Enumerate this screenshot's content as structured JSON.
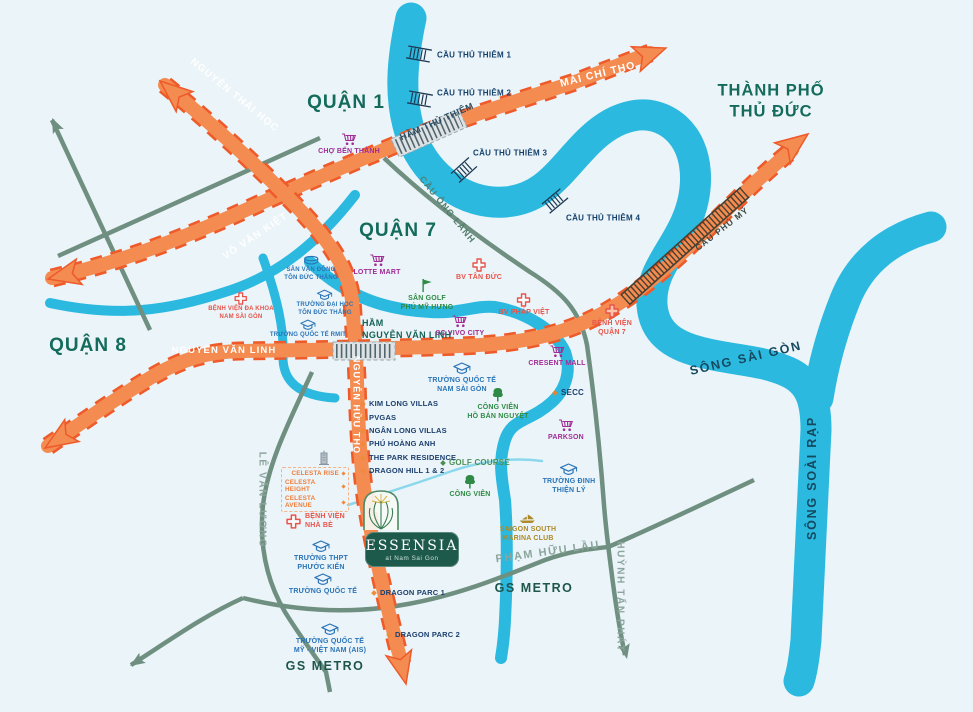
{
  "districts": {
    "quan1": "QUẬN 1",
    "quan7": "QUẬN 7",
    "quan8": "QUẬN 8",
    "thu_duc": "THÀNH PHỐ\nTHỦ ĐỨC"
  },
  "rivers": {
    "saigon": "SÔNG SÀI GÒN",
    "soai_rap": "SÔNG SOÀI RẠP"
  },
  "roads": {
    "nguyen_thai_hoc": "NGUYỄN THÁI HỌC",
    "mai_chi_tho": "MAI CHÍ THỌ",
    "vo_van_kiet": "VÕ VĂN KIỆT",
    "nguyen_van_linh": "NGUYỄN VĂN LINH",
    "nguyen_huu_tho": "NGUYỄN HỮU THỌ",
    "cau_phu_my": "CẦU PHÚ MỸ",
    "cau_ong_lanh": "CẦU ÔNG LÃNH",
    "le_van_luong": "LÊ VĂN LƯƠNG",
    "pham_huu_lau": "PHẠM HỮU LẦU",
    "huynh_tan_phat": "HUỲNH TẤN PHÁT"
  },
  "tunnels": {
    "ham_thu_thiem": "HẦM THỦ THIÊM",
    "ham_nguyen_van_linh": "HẦM\nNGUYỄN VĂN LINH"
  },
  "bridges": [
    "CẦU THỦ THIÊM 1",
    "CẦU THỦ THIÊM 2",
    "CẦU THỦ THIÊM 3",
    "CẦU THỦ THIÊM 4"
  ],
  "pois": {
    "cho_ben_thanh": "CHỢ BẾN THÀNH",
    "lotte_mart": "LOTTE MART",
    "bv_tan_duc": "BV TÂN ĐỨC",
    "san_golf_phu_my_hung": "SÂN GOLF\nPHÚ MỸ HƯNG",
    "bv_phap_viet": "BV PHÁP VIỆT",
    "sc_vivo_city": "SC VIVO CITY",
    "benh_vien_quan_7": "BỆNH VIỆN\nQUẬN 7",
    "cresent_mall": "CRESENT MALL",
    "secc": "SECC",
    "parkson": "PARKSON",
    "truong_qt_nam_sai_gon": "TRƯỜNG QUỐC TẾ\nNAM SÀI GÒN",
    "cong_vien_ho_ban_nguyet": "CÔNG VIÊN\nHỒ BÁN NGUYỆT",
    "golf_course": "GOLF COURSE",
    "cong_vien": "CÔNG VIÊN",
    "truong_dinh_thien_ly": "TRƯỜNG ĐINH\nTHIỆN LÝ",
    "san_van_dong_ton_duc_thang": "SÂN VẬN ĐỘNG\nTÔN ĐỨC THẮNG",
    "bv_da_khoa_nam_sai_gon": "BỆNH VIỆN ĐA KHOA\nNAM SÀI GÒN",
    "truong_dh_ton_duc_thang": "TRƯỜNG ĐẠI HỌC\nTÔN ĐỨC THẮNG",
    "truong_qt_rmit": "TRƯỜNG QUỐC TẾ RMIT",
    "benh_vien_nha_be": "BỆNH VIỆN\nNHÀ BÈ",
    "truong_thpt_phuoc_kien": "TRƯỜNG THPT\nPHƯỚC KIỂN",
    "truong_quoc_te": "TRƯỜNG QUỐC TẾ",
    "truong_qt_my_viet_nam": "TRƯỜNG QUỐC TẾ\nMỸ - VIỆT NAM (AIS)",
    "saigon_south_marina_club": "SAIGON SOUTH\nMARINA CLUB",
    "dragon_parc_1": "DRAGON PARC 1",
    "dragon_parc_2": "DRAGON PARC 2"
  },
  "villas": [
    "KIM LONG VILLAS",
    "PVGAS",
    "NGÂN LONG VILLAS",
    "PHÚ HOÀNG ANH",
    "THE PARK RESIDENCE",
    "DRAGON HILL 1 & 2"
  ],
  "celesta": [
    "CELESTA RISE",
    "CELESTA HEIGHT",
    "CELESTA AVENUE"
  ],
  "landmarks": {
    "gs_metro": "GS METRO"
  },
  "logo": {
    "name": "ESSENSIA",
    "tagline": "at Nam Sai Gon"
  },
  "colors": {
    "background": "#ebf4f8",
    "river": "#2cb9e0",
    "highway": "#f48b51",
    "highway_border": "#ee5a2a",
    "minor_road": "#6f8f80",
    "district_text": "#146b5c",
    "hospital": "#e8534a",
    "retail": "#a12c96",
    "school": "#2a74b8",
    "park": "#2e8a44",
    "project_text": "#1c3f6e",
    "celesta": "#ef7d3a",
    "marina": "#ae8a28",
    "logo_green": "#1d5a4c"
  }
}
